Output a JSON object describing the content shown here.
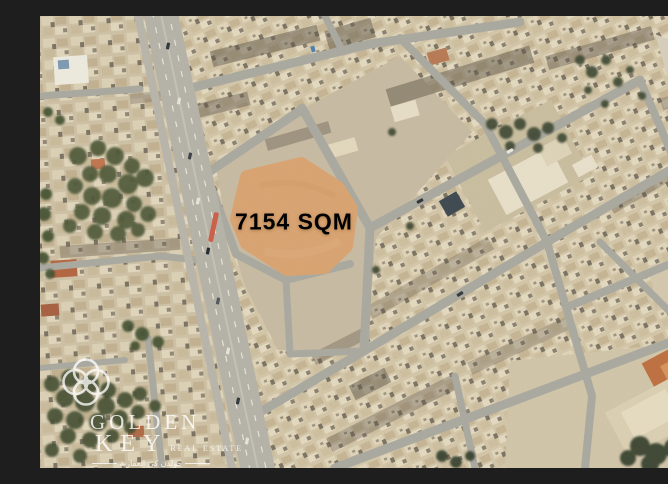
{
  "map": {
    "plot": {
      "label": "7154 SQM",
      "fill_color": "#dca46f",
      "text_color": "#ffffff"
    },
    "road_marker_color": "#d0543c"
  },
  "watermark": {
    "icon": "golden-key-quatrefoil-logo",
    "brand_line1": "GOLDEN",
    "brand_line2": "KEY",
    "tagline": "REAL ESTATE",
    "arabic_tagline": "جولدن كي العقارية",
    "color": "#ffffff"
  }
}
